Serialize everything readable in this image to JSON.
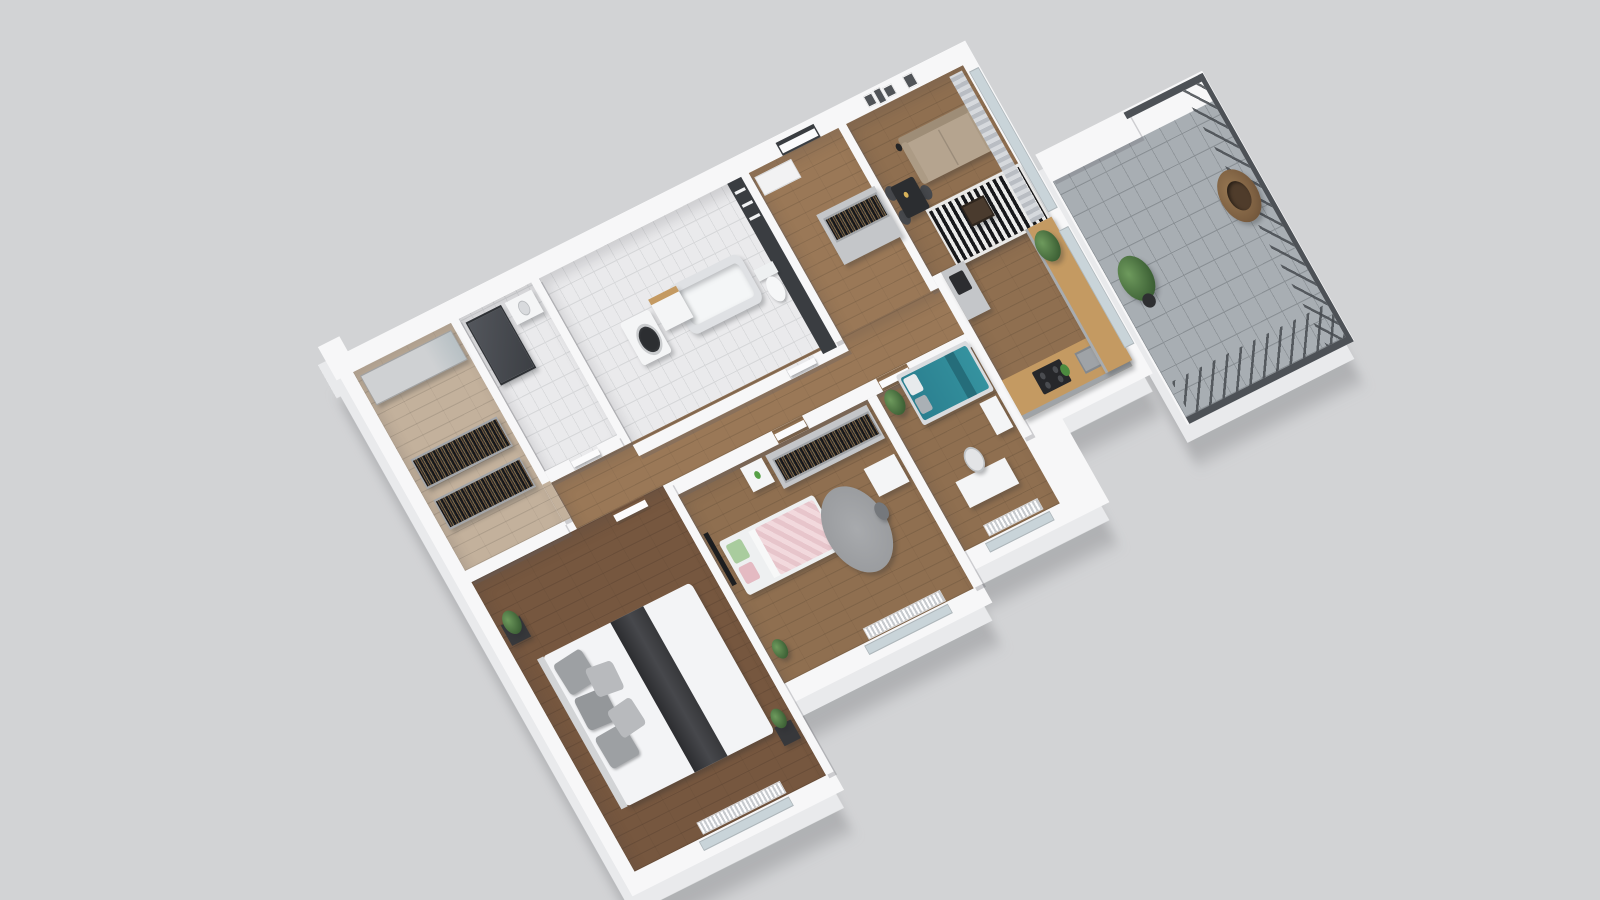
{
  "meta": {
    "title": "3D isometric apartment floor plan rendering",
    "view": "axonometric dollhouse top view",
    "background": "#d2d3d5"
  },
  "palette": {
    "background": "#d2d3d5",
    "wall_top": "#f7f7f8",
    "wall_face": "#e9eaec",
    "wood_floor": "#8f6f50",
    "wood_floor_dark": "#76573f",
    "wood_floor_warm": "#9a7857",
    "closet_floor": "#c3b19c",
    "bathroom_tile": "#eaeaec",
    "accent_wall_dark": "#3a3d41",
    "sofa_beige": "#b5a48f",
    "daybed_teal": "#2e8496",
    "kids_pink": "#e8c7cd",
    "pillow_green": "#a9cc9e",
    "kitchen_counter_wood": "#c49a62",
    "cabinet_grey": "#c4c6c9",
    "balcony_tile": "#a8aeb3",
    "railing_metal": "#4d5156",
    "plant_green": "#4e7a44",
    "rug_grey": "#a1a3a6",
    "glass_blue": "#c9d4d9",
    "css_vars": "--bg:#d2d3d5;--wall:#f7f7f8;--wall-face:#e9eaec;--wood:#8f6f50;--wood-dark:#76573f;--wood-warm:#9a7857;--wood-light:#c3b19c;--tile:#eaeaec;--tile-line:#d7d8da;--accent-dark:#3a3d41;--sofa:#b5a48f;--teal:#2e8496;--pink:#e8c7cd;--green:#a9cc9e;--counter:#c49a62;--cab:#c4c6c9;--balcony:#a8aeb3;--balcony-line:#8a9095;--rail:#4d5156;--plant:#4e7a44;--grey-rug:#a1a3a6;--glass:#c9d4d9;--curtain-a:#b9bdc3;--curtain-b:#d6d9dd;--radiator-a:#fdfdfe;--radiator-b:#c7cace"
  },
  "scene": {
    "rooms": [
      {
        "id": "living-room",
        "floor": "wood",
        "furniture": [
          "beige sofa",
          "black-white striped rug",
          "coffee table",
          "dining table with chairs",
          "floor lamp",
          "wall art frames",
          "curtains",
          "glass wall to balcony"
        ]
      },
      {
        "id": "kitchen",
        "floor": "wood",
        "furniture": [
          "U-shaped counter with wooden worktop",
          "cooktop",
          "sink",
          "tall cabinet",
          "coffee machine",
          "fruit bowl",
          "window to balcony"
        ]
      },
      {
        "id": "entry-hall",
        "floor": "wood",
        "furniture": [
          "front door",
          "wall shelf niche",
          "wardrobe cabinet with open clothes rail"
        ]
      },
      {
        "id": "family-bathroom",
        "floor": "tile",
        "furniture": [
          "bathtub",
          "washing machine",
          "vanity sink",
          "toilet",
          "dark accent wall with shelves"
        ]
      },
      {
        "id": "shower-room",
        "floor": "tile",
        "furniture": [
          "shower cabin",
          "vanity sink"
        ]
      },
      {
        "id": "walk-in-closet",
        "floor": "wood",
        "furniture": [
          "mirrored wardrobe",
          "open clothes rack",
          "open clothes rack"
        ]
      },
      {
        "id": "corridor",
        "floor": "wood",
        "furniture": [
          "interior doors"
        ]
      },
      {
        "id": "kids-bedroom",
        "floor": "wood",
        "furniture": [
          "bed with pink bedding and green pillow",
          "round grey rug",
          "desk with chair",
          "wardrobe with clothes rail",
          "dresser",
          "wall tv",
          "radiator",
          "plant"
        ]
      },
      {
        "id": "office-guest-room",
        "floor": "wood",
        "furniture": [
          "teal daybed with grey pillows",
          "desk with white chair",
          "dresser",
          "plant",
          "radiator"
        ]
      },
      {
        "id": "master-bedroom",
        "floor": "wood",
        "furniture": [
          "double bed with white duvet and dark runner",
          "grey pillows",
          "headboard",
          "two side tables",
          "plants",
          "radiator"
        ]
      },
      {
        "id": "balcony",
        "floor": "grey tile",
        "furniture": [
          "metal railing with diagonal balusters",
          "white parapet",
          "hanging rattan egg chair",
          "plant"
        ]
      }
    ]
  }
}
